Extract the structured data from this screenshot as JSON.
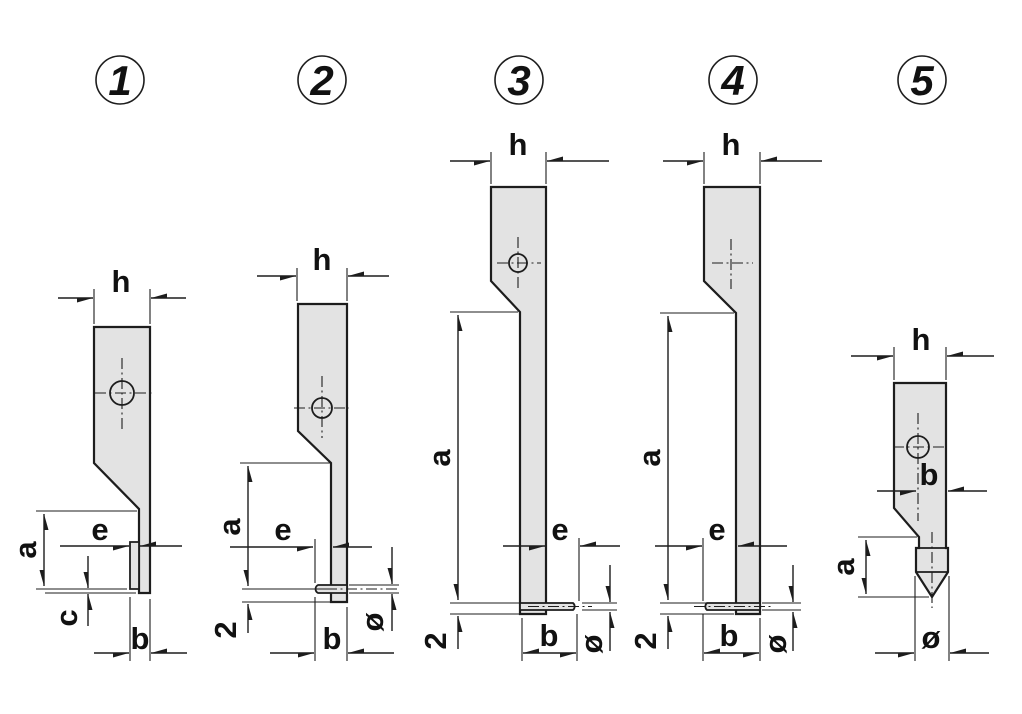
{
  "drawing": {
    "background_color": "#ffffff",
    "stroke_color": "#1d1d1d",
    "part_fill_color": "#e3e3e3",
    "description_labels": [
      "h",
      "e",
      "a",
      "c",
      "b",
      "2",
      "ø"
    ]
  },
  "figures": [
    {
      "number": "1",
      "labels": {
        "h": "h",
        "e": "e",
        "a": "a",
        "c": "c",
        "b": "b"
      }
    },
    {
      "number": "2",
      "labels": {
        "h": "h",
        "e": "e",
        "a": "a",
        "two": "2",
        "b": "b",
        "dia": "ø"
      }
    },
    {
      "number": "3",
      "labels": {
        "h": "h",
        "e": "e",
        "a": "a",
        "two": "2",
        "b": "b",
        "dia": "ø"
      }
    },
    {
      "number": "4",
      "labels": {
        "h": "h",
        "e": "e",
        "a": "a",
        "two": "2",
        "b": "b",
        "dia": "ø"
      }
    },
    {
      "number": "5",
      "labels": {
        "h": "h",
        "b": "b",
        "a": "a",
        "dia": "ø"
      }
    }
  ]
}
